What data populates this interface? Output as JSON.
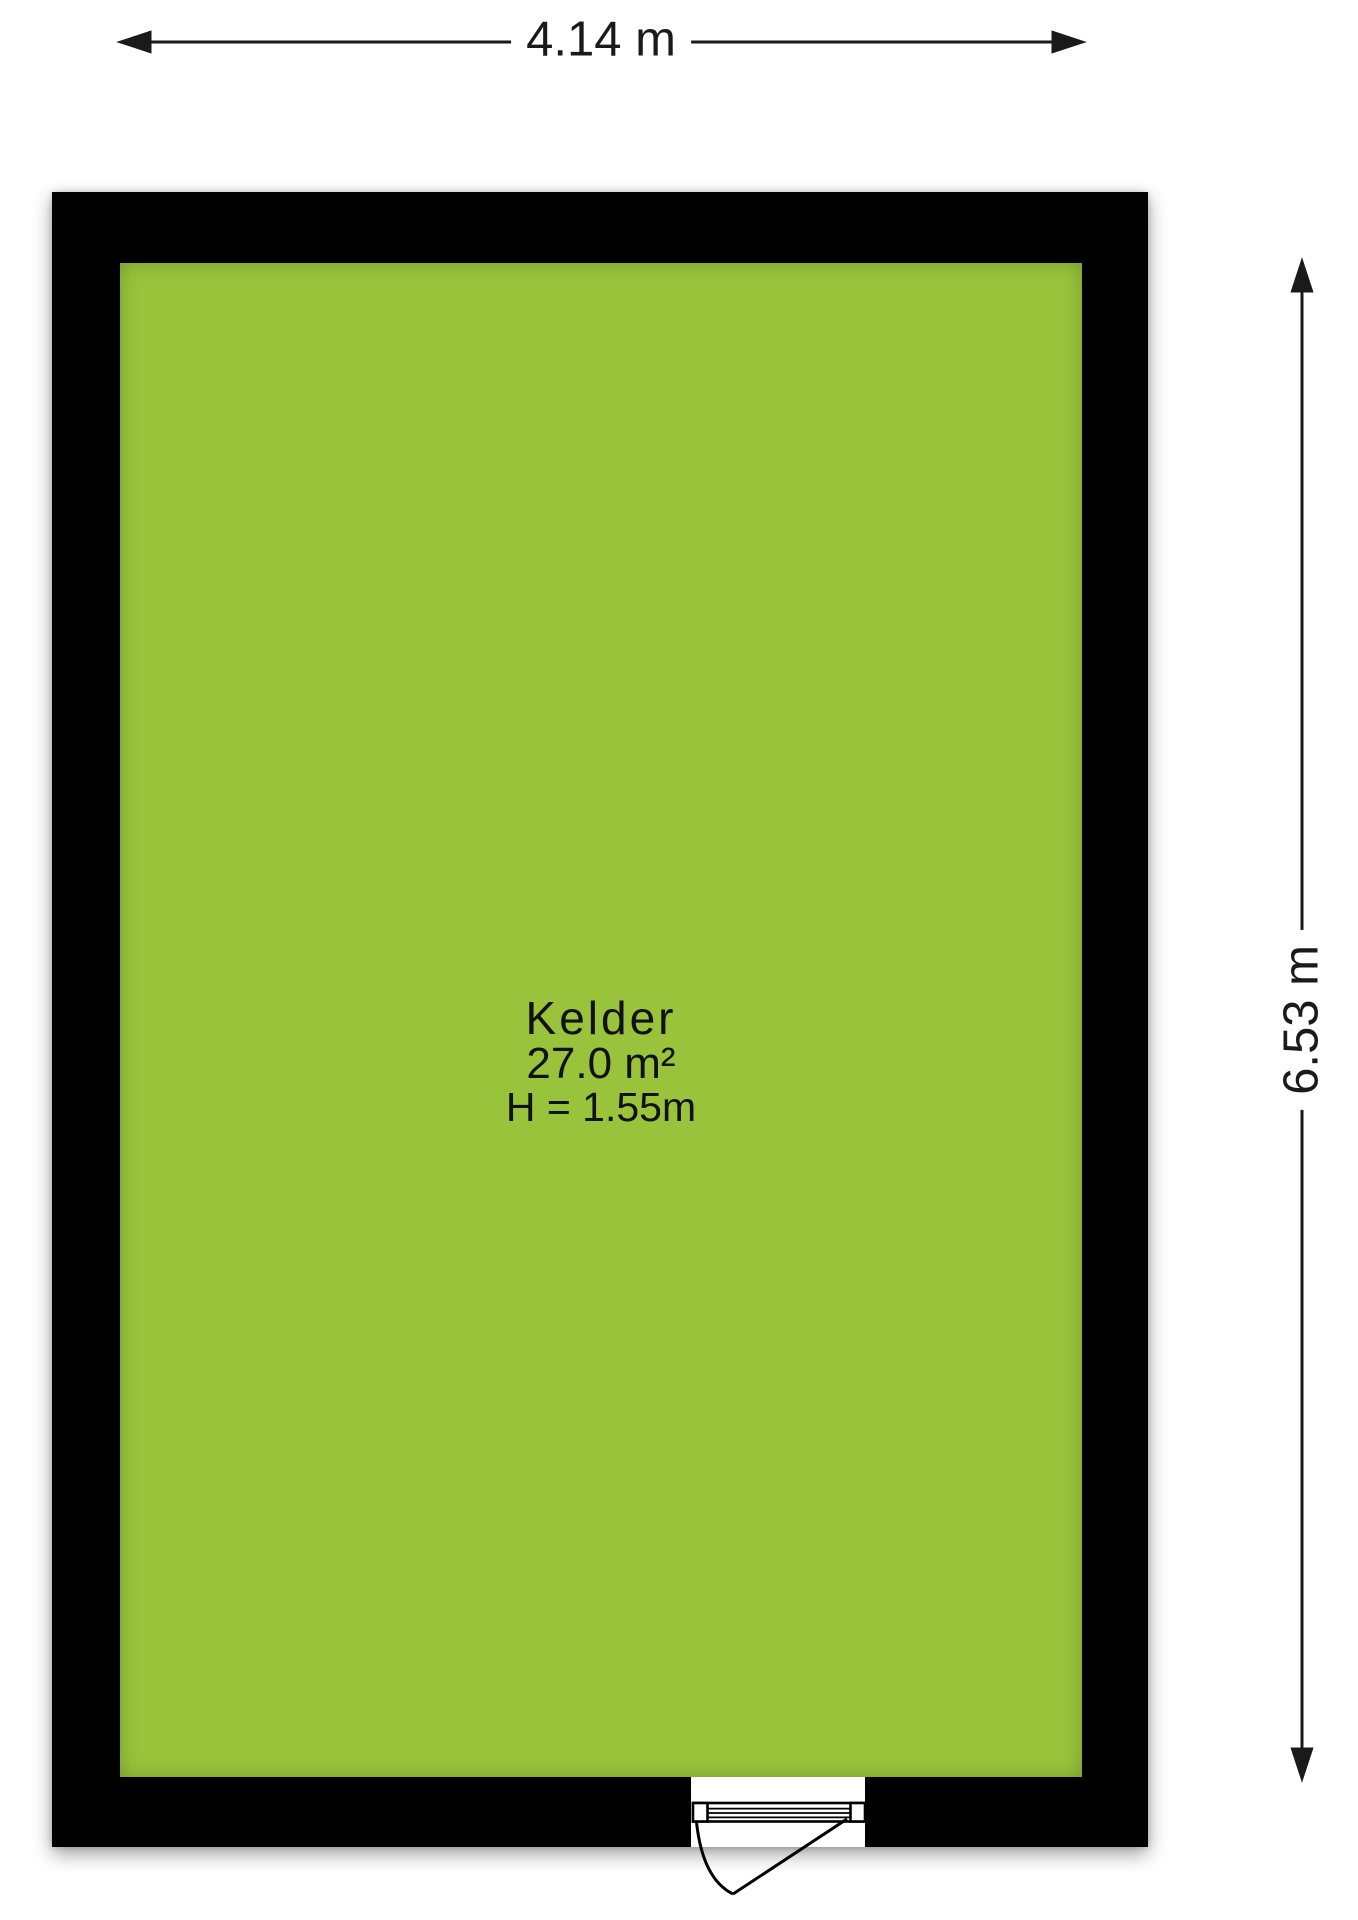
{
  "floorplan": {
    "room": {
      "name": "Kelder",
      "area": "27.0 m²",
      "ceiling_height": "H = 1.55m"
    },
    "dimensions": {
      "width_label": "4.14 m",
      "height_label": "6.53 m"
    },
    "colors": {
      "floor_fill": "#98C33B",
      "wall": "#000000",
      "line": "#1a1a1a",
      "background": "#ffffff"
    }
  }
}
